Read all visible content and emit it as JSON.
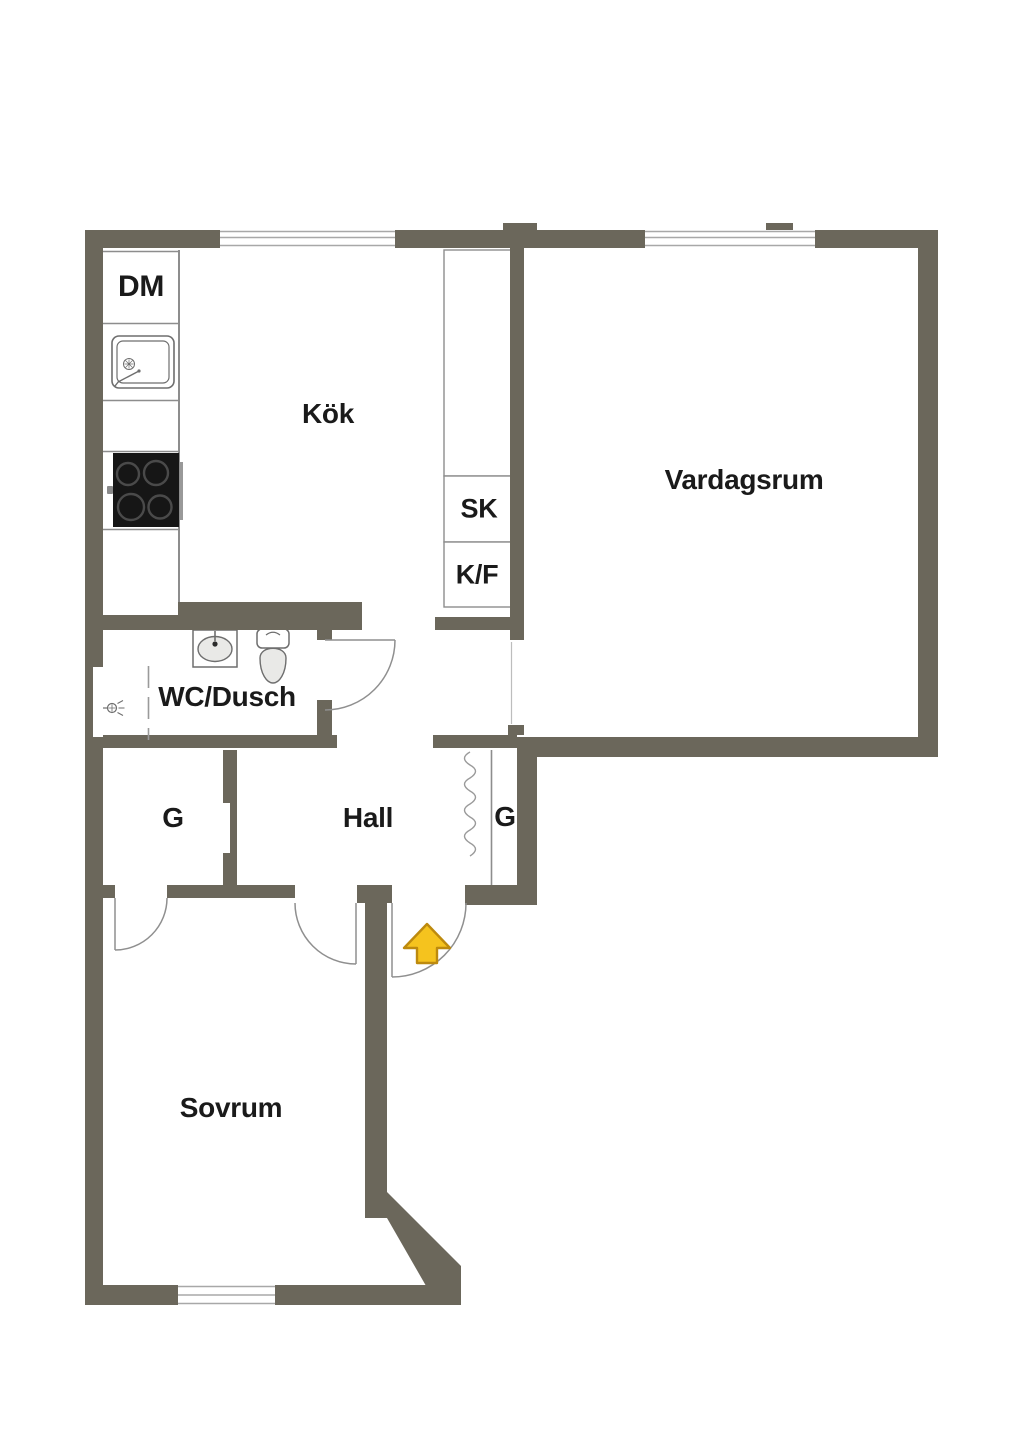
{
  "plan_type": "apartment-floor-plan",
  "labels": {
    "kitchen": "Kök",
    "living_room": "Vardagsrum",
    "bathroom": "WC/Dusch",
    "hall": "Hall",
    "bedroom": "Sovrum",
    "dishwasher": "DM",
    "tall_closet": "SK",
    "fridge_freezer": "K/F",
    "wardrobe_left": "G",
    "wardrobe_right": "G"
  },
  "icons": {
    "entrance_arrow": "up-arrow",
    "kitchen_sink": "sink-top-view",
    "stove": "cooktop-4-burners",
    "wash_basin": "washbasin-top-view",
    "toilet": "toilet-top-view",
    "shower": "shower-mixer",
    "wardrobe_curtain": "wavy-curtain-line",
    "doors": "quarter-circle-door-swing",
    "windows": "triple-line-window"
  },
  "colors": {
    "wall": "#6b675b",
    "floor": "#ffffff",
    "text": "#1a1a1a",
    "line": "#8d8d8d",
    "line_light": "#a8a8a8",
    "fixture_line": "#6e6e6e",
    "basin_fill": "#e9e9e7",
    "stove_body": "#161616",
    "stove_ring": "#4a4a4a",
    "arrow_fill": "#f5c31e",
    "arrow_stroke": "#bd8a0e"
  }
}
